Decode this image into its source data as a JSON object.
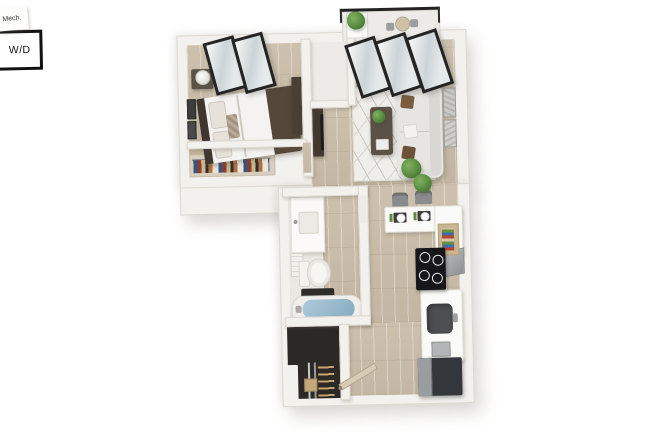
{
  "labels": {
    "mech_closet": "Mech.",
    "washer_dryer": "W/D"
  },
  "colors": {
    "background": "#ffffff",
    "wall": "#f3f1ed",
    "wall_edge": "#dcd8d0",
    "floor_wood": "#cdc1ae",
    "floor_wood_dark": "#c3b6a2",
    "floor_light": "#ecebe7",
    "rug": "#f0eeea",
    "rug_line": "#c9c5bf",
    "window_frame": "#242424",
    "glass": "#ccd4d7",
    "sofa": "#e6e5e2",
    "pillow_brown": "#7b5c3e",
    "bed_frame": "#554739",
    "duvet": "#f4f3f1",
    "wood_furniture": "#5a5147",
    "plant": "#55863f",
    "tub_water": "#96b8cb",
    "appliance_dark": "#33363a",
    "cooktop": "#17171a",
    "closet_dark": "#2b2826",
    "label_text": "#3a3a3a",
    "wd_border": "#121212"
  },
  "rooms": {
    "bedroom": [
      "bed",
      "nightstand",
      "table-lamp",
      "wall-art",
      "closet-with-clothes",
      "dresser",
      "windows"
    ],
    "mechanical_closet": [
      "mech-label"
    ],
    "living_room": [
      "sofa",
      "coffee-table",
      "area-rug",
      "wall-art",
      "floor-plant",
      "tv-console",
      "windows"
    ],
    "balcony": [
      "railing",
      "planter",
      "bistro-table",
      "bistro-chairs"
    ],
    "bathroom": [
      "vanity-sink",
      "toilet",
      "bathtub",
      "bath-mat",
      "towels"
    ],
    "laundry_closet": [
      "washer-dryer",
      "hanging-closet"
    ],
    "kitchen": [
      "breakfast-bar",
      "bar-stools",
      "place-settings",
      "shelf-unit",
      "cooktop",
      "range-hood",
      "kitchen-sink",
      "refrigerator"
    ],
    "entry": [
      "entry-door"
    ]
  }
}
